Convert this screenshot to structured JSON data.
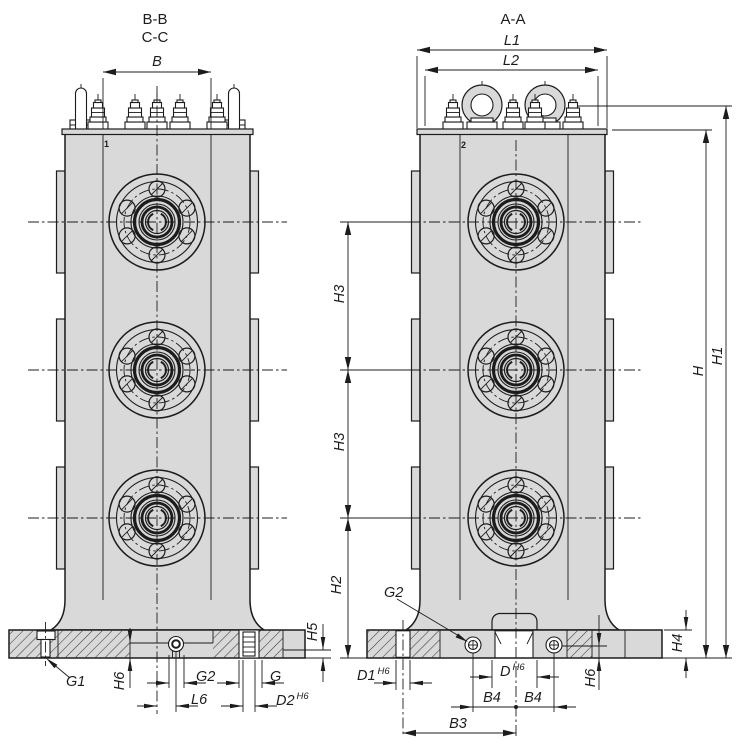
{
  "meta": {
    "type": "technical-drawing",
    "views": 2
  },
  "colors": {
    "line": "#1c1c1c",
    "body_fill": "#d9d9d9",
    "background": "#ffffff"
  },
  "left_view": {
    "title_top": "B-B",
    "title_bottom": "C-C",
    "part_marker": "1",
    "dims": {
      "b": "B",
      "g1": "G1",
      "h6": "H6",
      "g2": "G2",
      "l6": "L6",
      "g": "G",
      "d2": "D2",
      "d2_tol": "H6",
      "h5": "H5"
    }
  },
  "right_view": {
    "title": "A-A",
    "part_marker": "2",
    "dims": {
      "l1": "L1",
      "l2": "L2",
      "h3_upper": "H3",
      "h3_lower": "H3",
      "h2": "H2",
      "h": "H",
      "h1": "H1",
      "h4": "H4",
      "h6": "H6",
      "g2": "G2",
      "d1": "D1",
      "d1_tol": "H6",
      "d": "D",
      "d_tol": "H6",
      "b4_left": "B4",
      "b4_right": "B4",
      "b3": "B3"
    }
  }
}
